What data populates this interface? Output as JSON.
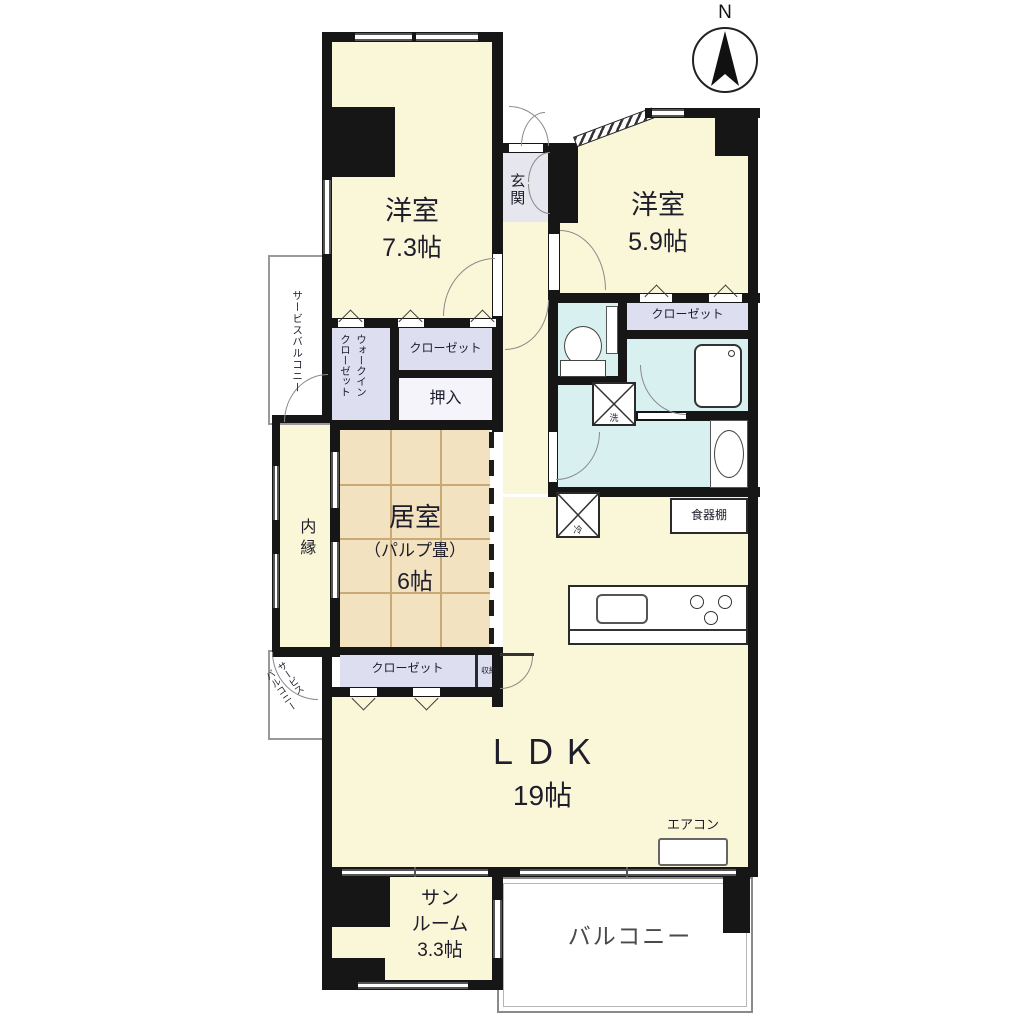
{
  "compass": {
    "north_label": "N"
  },
  "rooms": {
    "western_room_1": {
      "label": "洋室",
      "size": "7.3帖"
    },
    "western_room_2": {
      "label": "洋室",
      "size": "5.9帖"
    },
    "entrance": {
      "label": "玄関"
    },
    "tatami_room": {
      "label": "居室",
      "note": "（パルプ畳）",
      "size": "6帖"
    },
    "ldk": {
      "label": "ＬＤＫ",
      "size": "19帖"
    },
    "sunroom": {
      "line1": "サン",
      "line2": "ルーム",
      "size": "3.3帖"
    },
    "balcony": {
      "label": "バルコニー"
    },
    "inner_veranda": {
      "label": "内縁"
    },
    "service_balcony_top": {
      "label": "サービスバルコニー"
    },
    "service_balcony_bottom": {
      "line1": "サービス",
      "line2": "バルコニー"
    }
  },
  "storage": {
    "walk_in_closet": {
      "line1": "ウォークイン",
      "line2": "クローゼット"
    },
    "closet_upper": {
      "label": "クローゼット"
    },
    "closet_right": {
      "label": "クローゼット"
    },
    "closet_lower": {
      "label": "クローゼット"
    },
    "oshiire": {
      "label": "押入"
    },
    "storage_small": {
      "label": "収納"
    },
    "cupboard": {
      "label": "食器棚"
    }
  },
  "equipment": {
    "aircon": {
      "label": "エアコン"
    },
    "laundry_space": {
      "label": "洗"
    },
    "refrigerator_space": {
      "label": "冷"
    }
  },
  "colors": {
    "floor_cream": "#FAF6D8",
    "tatami_beige": "#F2E2C0",
    "closet_lavender": "#DEDEF1",
    "wet_area_cyan": "#D9F0F0",
    "entrance_gray": "#E6E6EE",
    "wall_black": "#161616",
    "balcony_white": "#FFFFFF"
  }
}
